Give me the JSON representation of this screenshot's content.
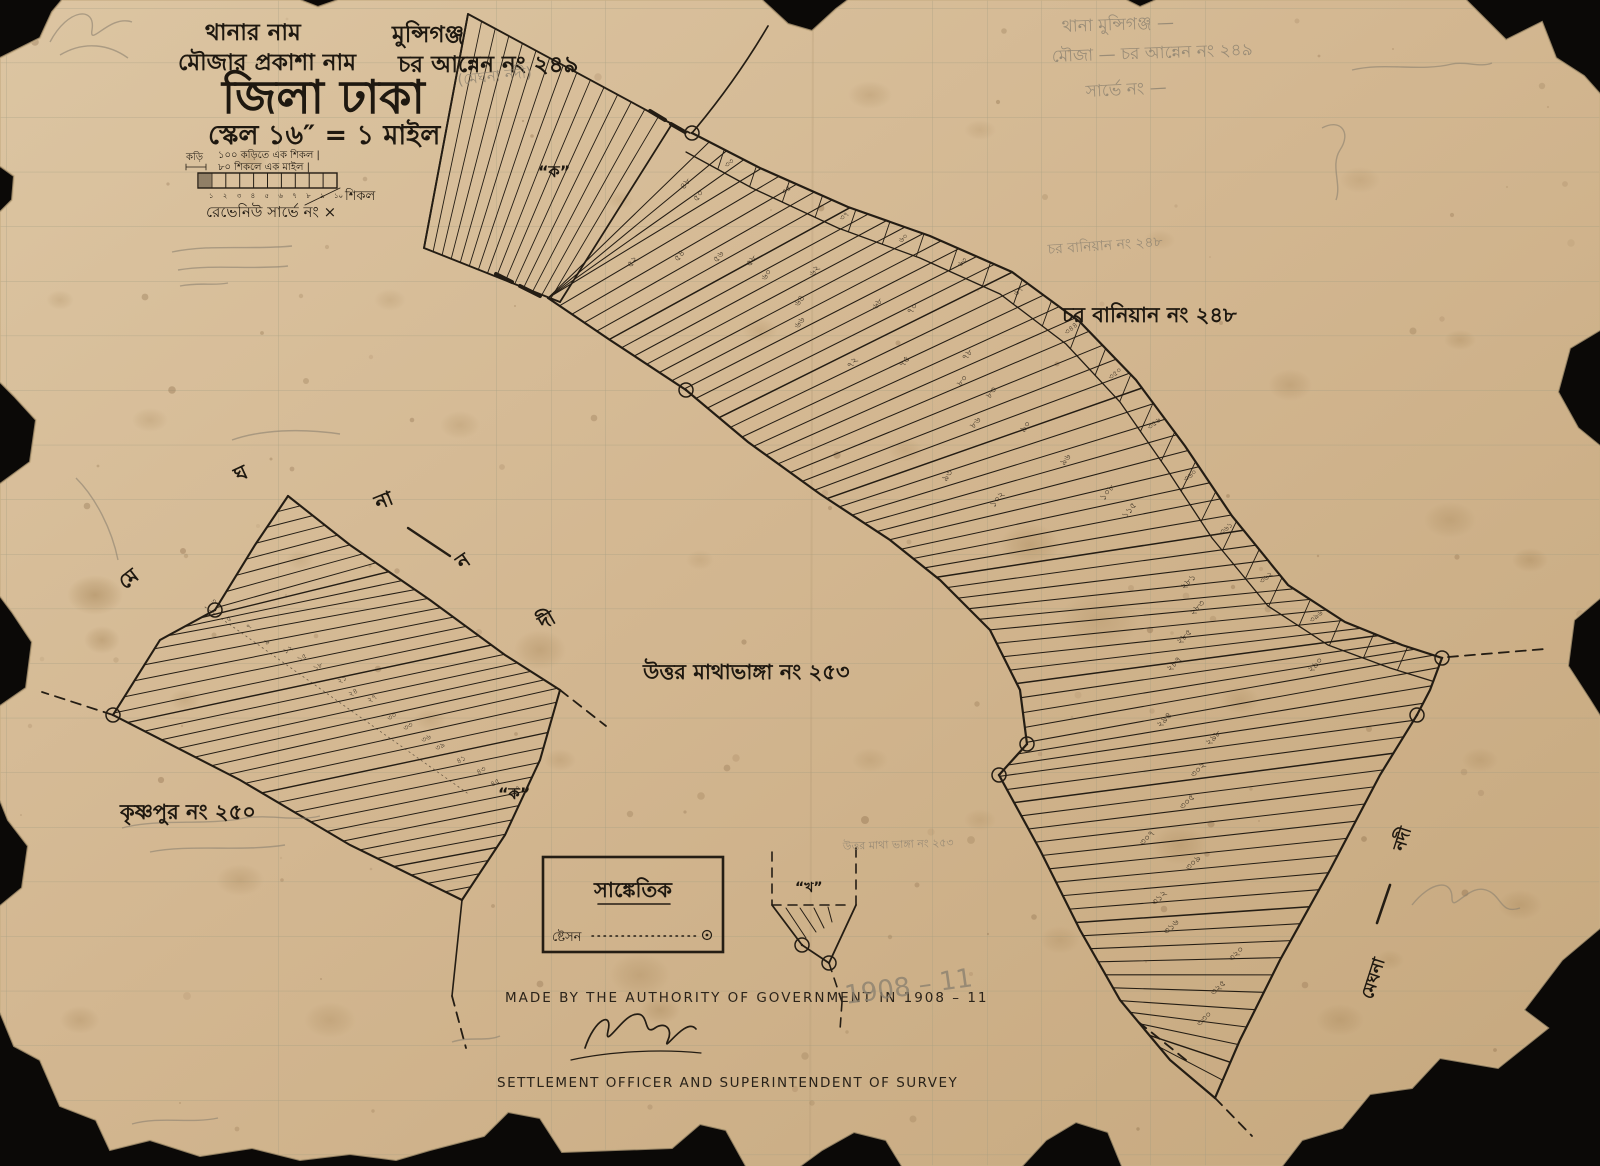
{
  "header": {
    "line1_label": "থানার নাম",
    "line1_value": "মুন্সিগঞ্জ",
    "line2_label": "মৌজার প্রকাশা নাম",
    "line2_value": "চর আন্নেন নং ২৪৯",
    "district": "জিলা ঢাকা",
    "scale": "স্কেল ১৬″ = ১ মাইল"
  },
  "scalebar": {
    "unit_small": "কড়ি",
    "line1": "১০০ কড়িতে এক শিকল  |",
    "line2": "৮০ শিকলে এক মাইল  |",
    "unit_right": "শিকল",
    "revenue": "রেভেনিউ সার্ভে নং  ×",
    "ticks": [
      "১",
      "২",
      "৩",
      "৪",
      "৫",
      "৬",
      "৭",
      "৮",
      "৯",
      "১০"
    ]
  },
  "labels": {
    "char_baniyan": "চর বানিয়ান নং ২৪৮",
    "uttar_mathabhanga": "উত্তর মাথাভাঙ্গা নং ২৫৩",
    "krishnapur": "কৃষ্ণপুর নং ২৫০"
  },
  "sections": {
    "ka_top": "“ক”",
    "ka_left": "“ক”",
    "kha": "“খ”"
  },
  "river": {
    "word_name": "মেঘনা",
    "word_river": "নদী",
    "letters": [
      "মে",
      "ঘ",
      "না",
      "ন",
      "দী"
    ]
  },
  "legend": {
    "title": "সাঙ্কেতিক",
    "station": "ষ্টেসন"
  },
  "footer": {
    "line1": "MADE BY THE AUTHORITY OF GOVERNMENT IN 1908 – 11",
    "line2": "SETTLEMENT OFFICER AND SUPERINTENDENT OF SURVEY"
  },
  "pencil_notes": {
    "thana": "থানা মুন্সিগঞ্জ —",
    "mouza": "মৌজা — চর আন্নেন নং ২৪৯",
    "survey": "সার্ভে নং —",
    "river_note": "(মেঘনা নদী)",
    "baniyan_note": "চর বানিয়ান নং ২৪৮",
    "mathabhanga_note": "উত্তর মাথা ভাঙ্গা নং ২৫৩",
    "year": "1908 – 11"
  },
  "plot_numbers": {
    "band": [
      "৪৮",
      "৫০",
      "৫২",
      "৫৪",
      "৫৬",
      "৫৮",
      "৬০",
      "৬২",
      "৬৪",
      "৬৬",
      "৬৮",
      "৭০",
      "৭২",
      "৭৫",
      "৭৮",
      "৮০",
      "৮৩",
      "৮৬",
      "৯০",
      "৯৩",
      "৯৬",
      "১০২",
      "১০৮",
      "১১৫"
    ],
    "parcel": [
      "২৮১",
      "২৮৩",
      "২৮৫",
      "২৮৭",
      "২৯০",
      "২৯৪",
      "২৯৮",
      "৩০২",
      "৩০৫",
      "৩০৭",
      "৩০৯",
      "৩১২",
      "৩১৬",
      "৩২০",
      "৩২৫",
      "৩৩০"
    ],
    "lane": [
      "৩৩",
      "৩৫",
      "৩৭",
      "৬০",
      "৬৩",
      "৬৭",
      "৩৪৪",
      "৩৫০",
      "৩৫৬",
      "৩৬০",
      "৩৬১",
      "৩৬২",
      "৩৯৬"
    ],
    "krishnapur_side": [
      "৩",
      "৫",
      "৭",
      "৯",
      "১২",
      "১৫",
      "১৮",
      "২১",
      "২৪",
      "২৭",
      "৩০",
      "৩৩",
      "৩৬",
      "৩৯",
      "৪১",
      "৪৩",
      "৪৫",
      "৪৭"
    ]
  },
  "colors": {
    "paper_light": "#dcc5a2",
    "paper_mid": "#d2b690",
    "paper_dark": "#c6a87e",
    "ink": "#241d14",
    "pencil": "#8b8170",
    "grid": "#9d9a80",
    "stain": "#93703f",
    "background": "#0b0907"
  }
}
